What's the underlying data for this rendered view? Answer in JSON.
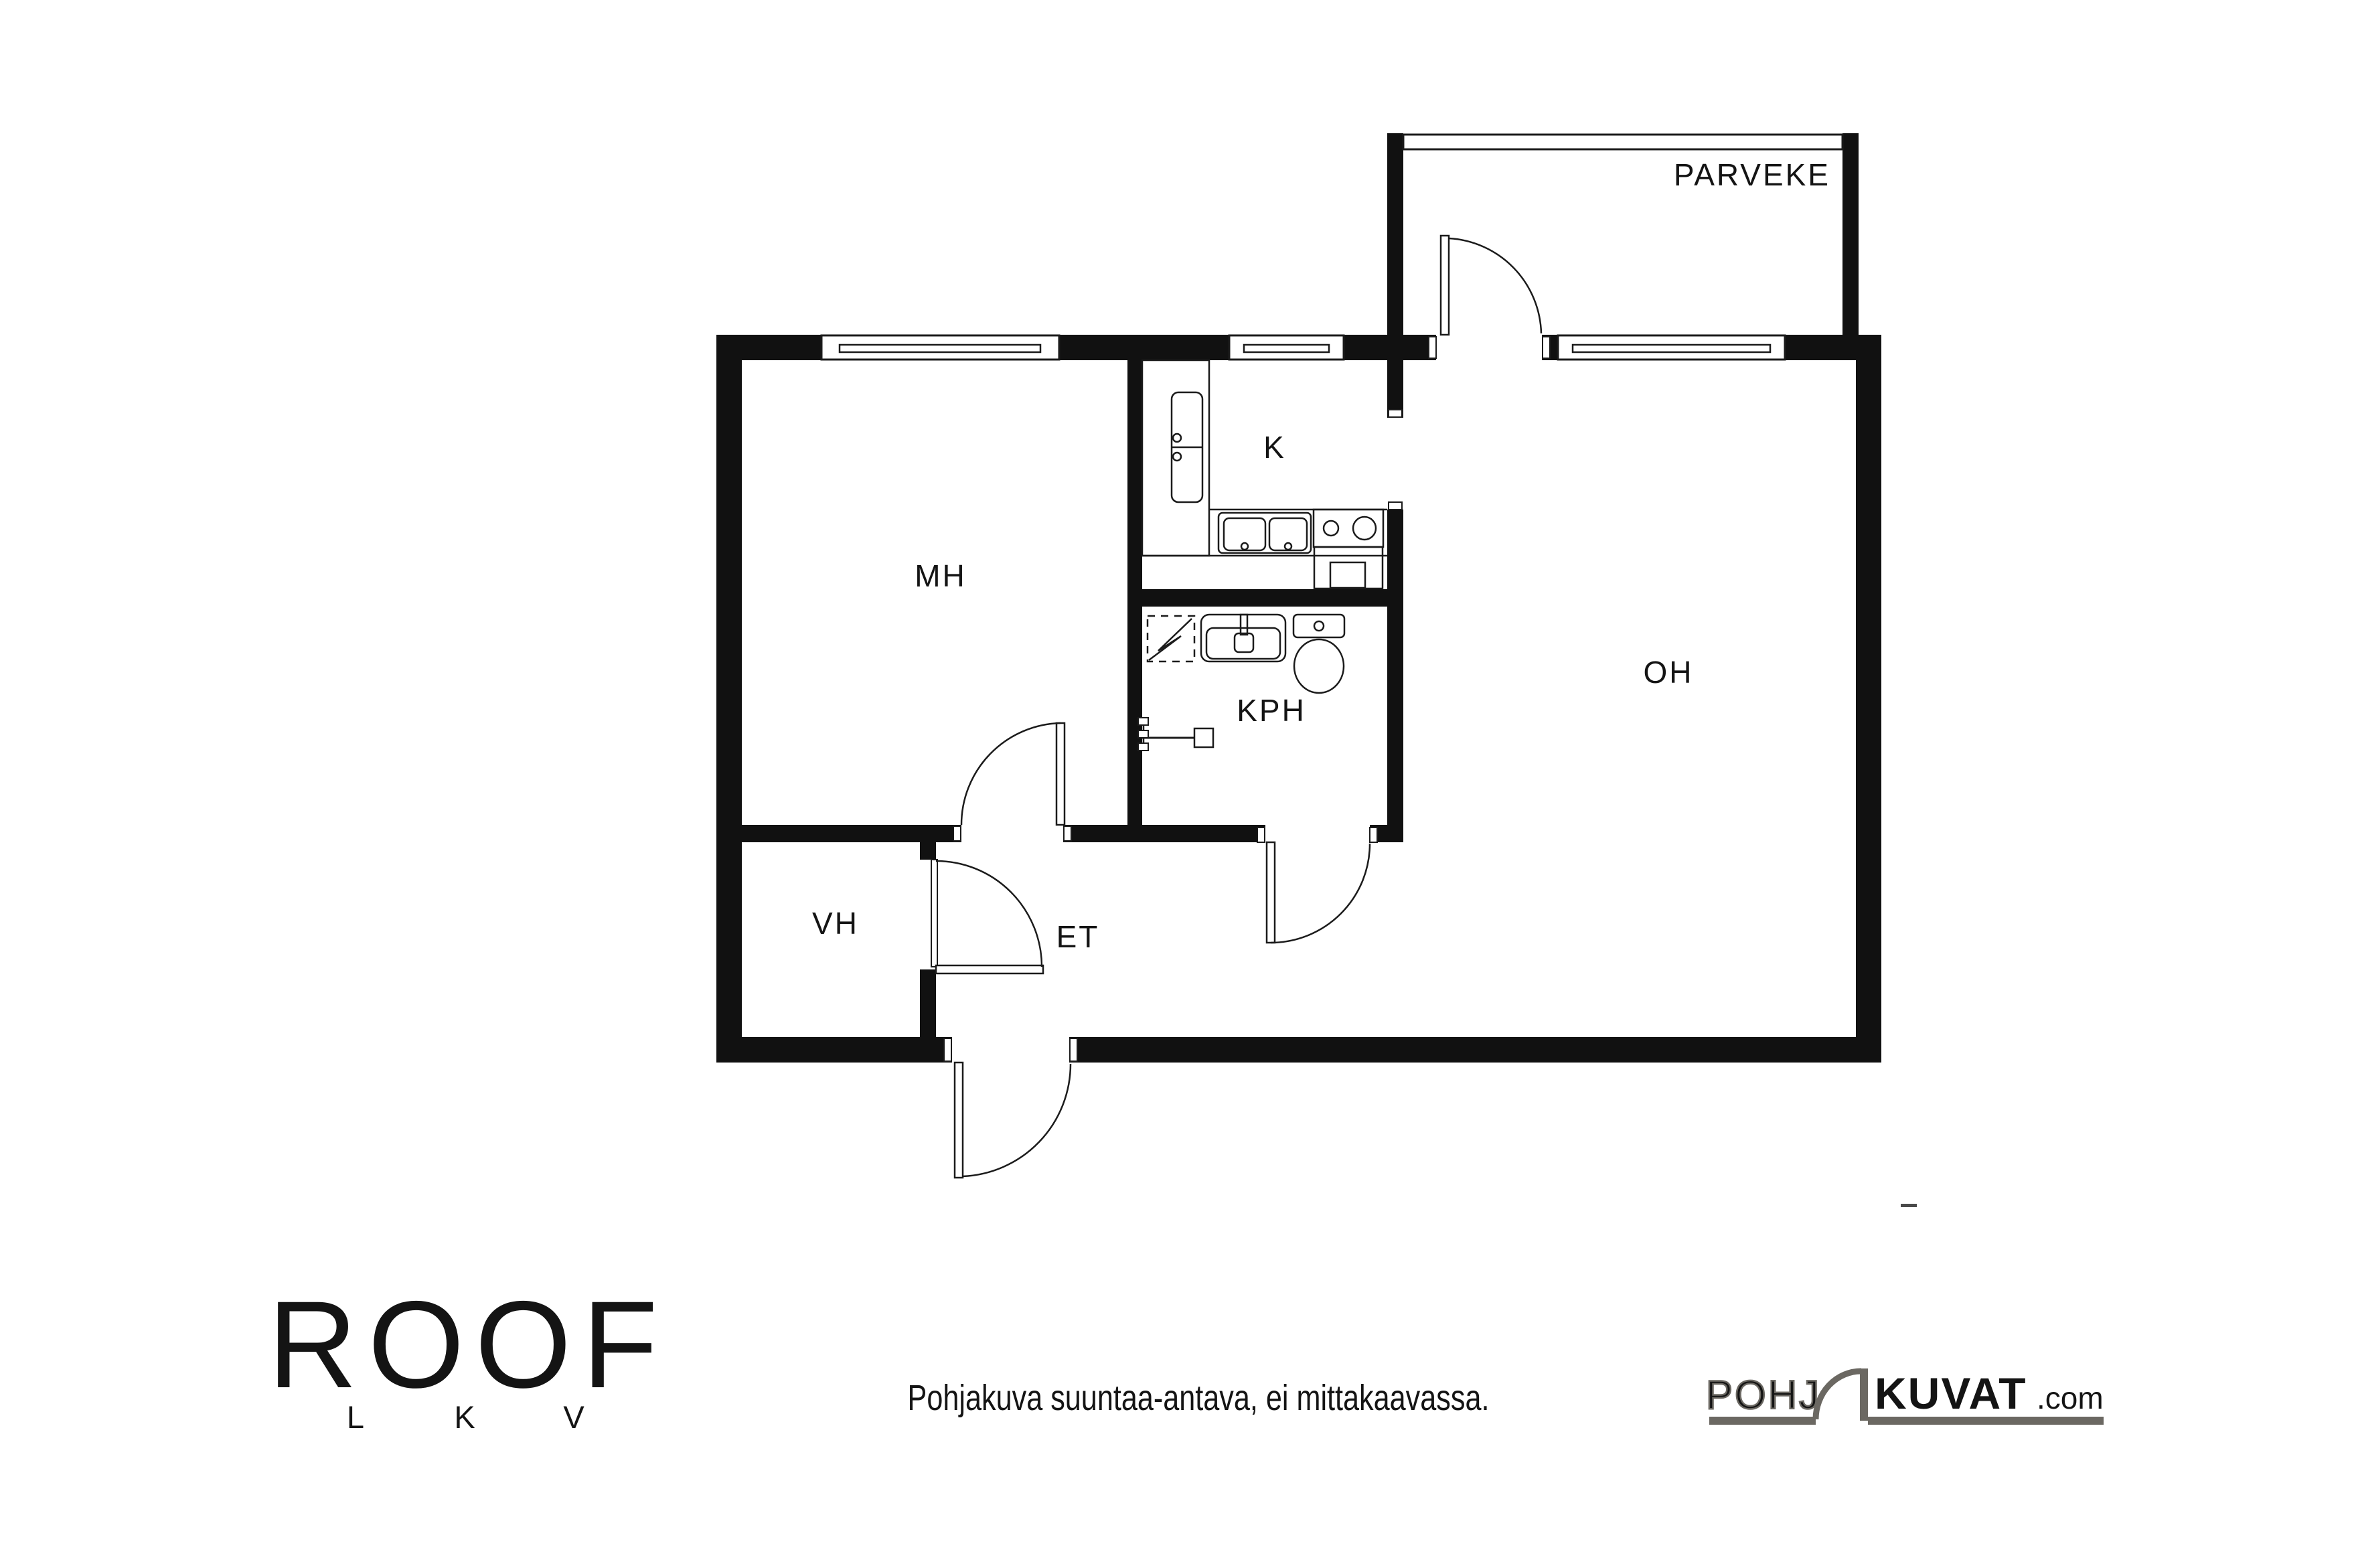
{
  "rooms": {
    "parveke": "PARVEKE",
    "mh": "MH",
    "k": "K",
    "oh": "OH",
    "kph": "KPH",
    "vh": "VH",
    "et": "ET"
  },
  "footer": {
    "roof_logo": {
      "word": "ROOF",
      "letters": [
        "L",
        "K",
        "V"
      ]
    },
    "disclaimer": "Pohjakuva suuntaa-antava, ei mittakaavassa.",
    "pohjakuvat_logo": {
      "outline": "POHJ",
      "solid": "KUVAT",
      "suffix": ".com"
    }
  },
  "colors": {
    "wall": "#111111",
    "line": "#1b1b1b",
    "label": "#141414",
    "watermark_gray": "#6b6862"
  }
}
